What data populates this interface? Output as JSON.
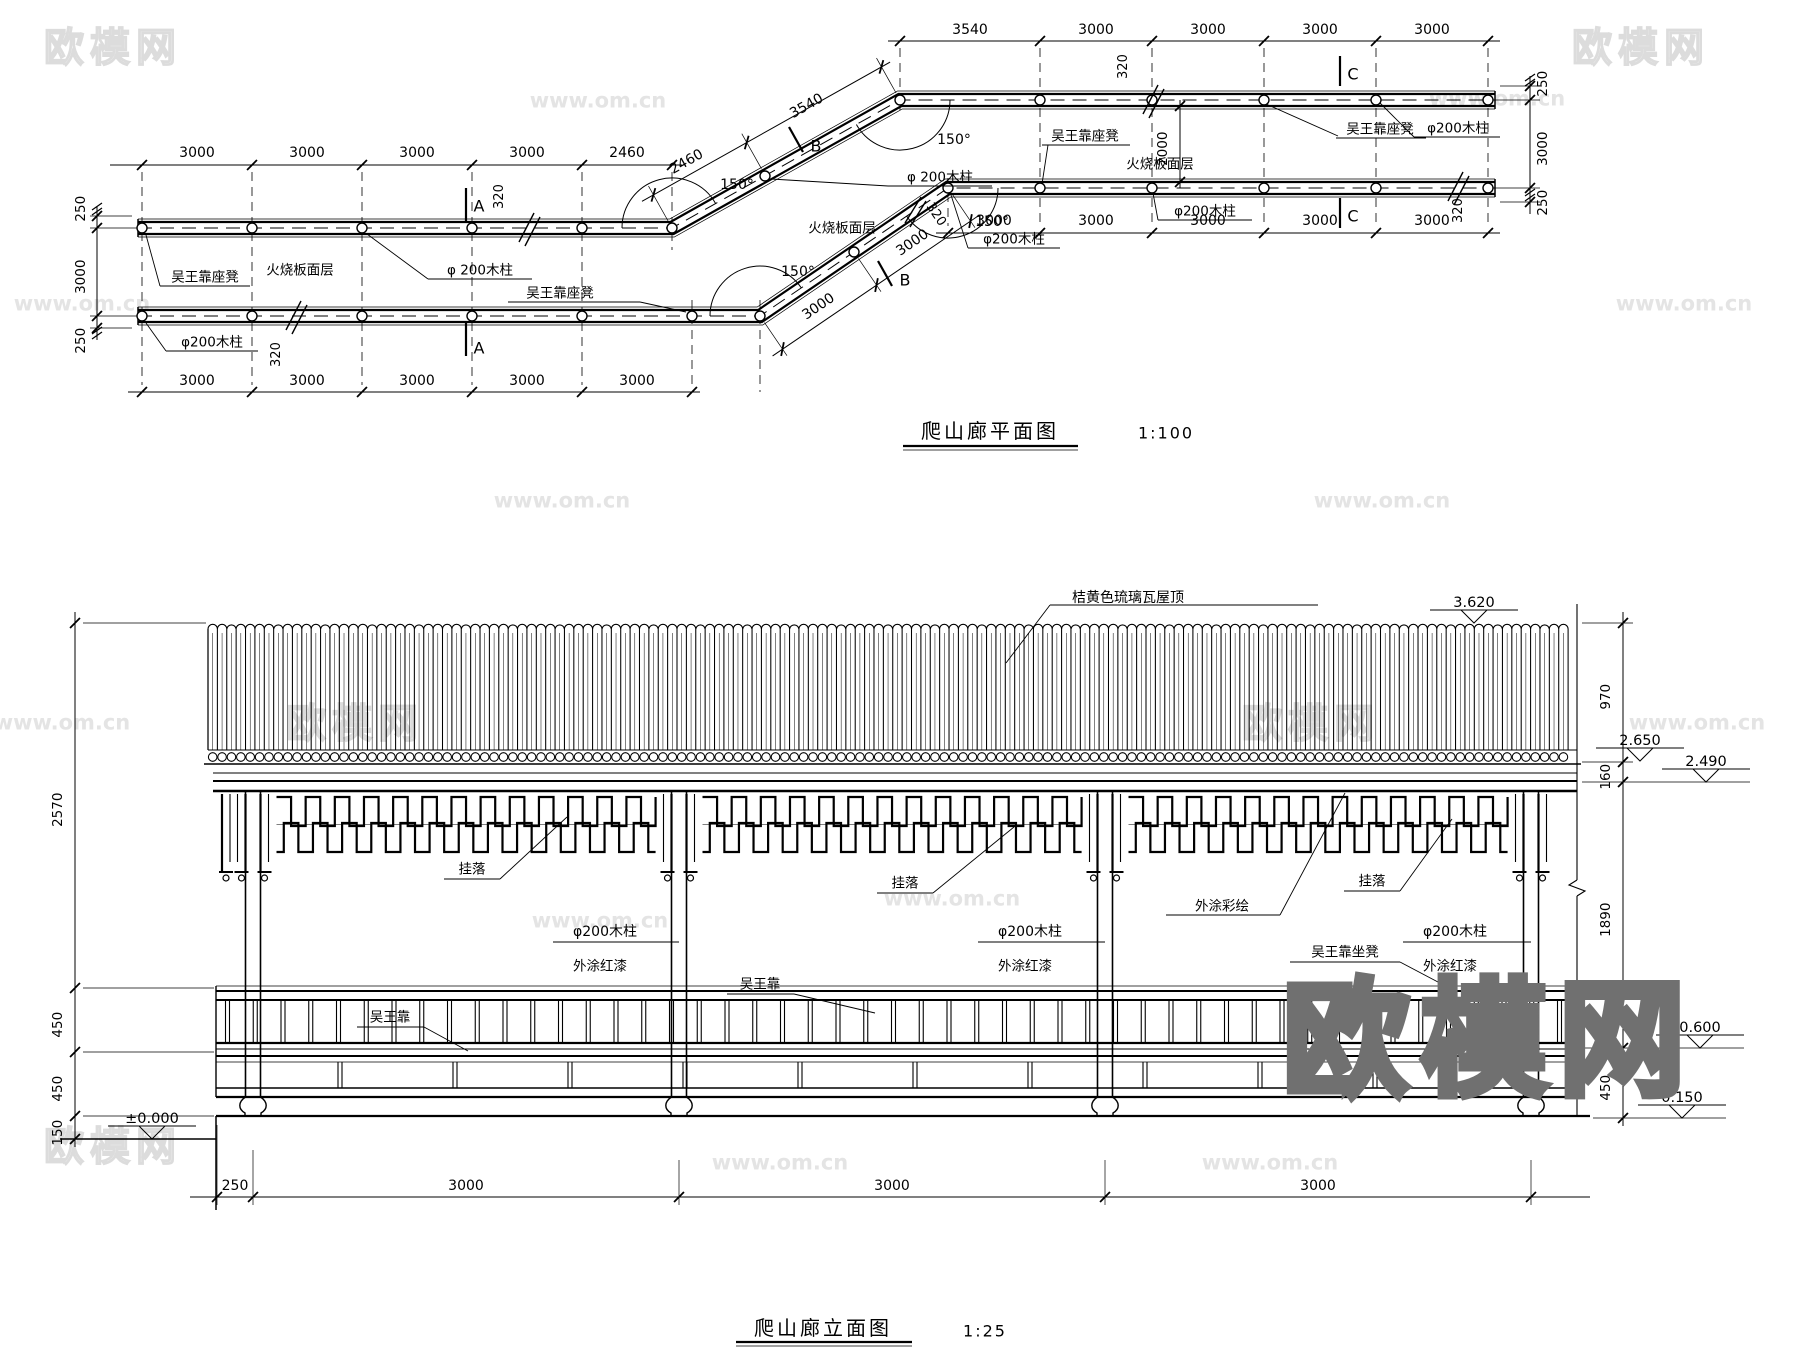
{
  "watermark": {
    "brand": "欧模网",
    "site": "www.om.cn"
  },
  "plan": {
    "title": "爬山廊平面图",
    "scale_label": "1:100",
    "angle": "150°",
    "dims": {
      "top_left": [
        "3000",
        "3000",
        "3000",
        "3000",
        "2460"
      ],
      "bottom_left": [
        "3000",
        "3000",
        "3000",
        "3000",
        "3000"
      ],
      "diag_upper": [
        "2460",
        "3540"
      ],
      "diag_lower": [
        "3000",
        "3000"
      ],
      "top_right": [
        "3540",
        "3000",
        "3000",
        "3000",
        "3000"
      ],
      "bottom_right": [
        "3000",
        "3000",
        "3000",
        "3000",
        "3000"
      ],
      "left_vert": [
        "250",
        "3000",
        "250"
      ],
      "right_vert": [
        "250",
        "3000",
        "250"
      ],
      "clear_width": "2000",
      "beam": "320"
    },
    "labels": {
      "seat_bench": "吴王靠座凳",
      "floor": "火烧板面层",
      "wood_column": "φ200木柱",
      "wood_column_sp": "φ 200木柱"
    },
    "sections": {
      "a": "A",
      "b": "B",
      "c": "C"
    }
  },
  "elevation": {
    "title": "爬山廊立面图",
    "scale_label": "1:25",
    "labels": {
      "roof": "桔黄色琉璃瓦屋顶",
      "fret": "挂落",
      "painted": "外涂彩绘",
      "wood_column": "φ200木柱",
      "red_paint": "外涂红漆",
      "backrest": "吴王靠",
      "seat_bench": "吴王靠坐凳"
    },
    "levels": {
      "ridge": "3.620",
      "eave": "2.650",
      "beam": "2.490",
      "seat": "0.600",
      "platform": "0.150",
      "ground": "±0.000"
    },
    "dims": {
      "right": [
        "970",
        "160",
        "1890",
        "450"
      ],
      "left": [
        "2570",
        "450",
        "450",
        "150"
      ],
      "bottom": [
        "250",
        "3000",
        "3000",
        "3000"
      ]
    }
  }
}
